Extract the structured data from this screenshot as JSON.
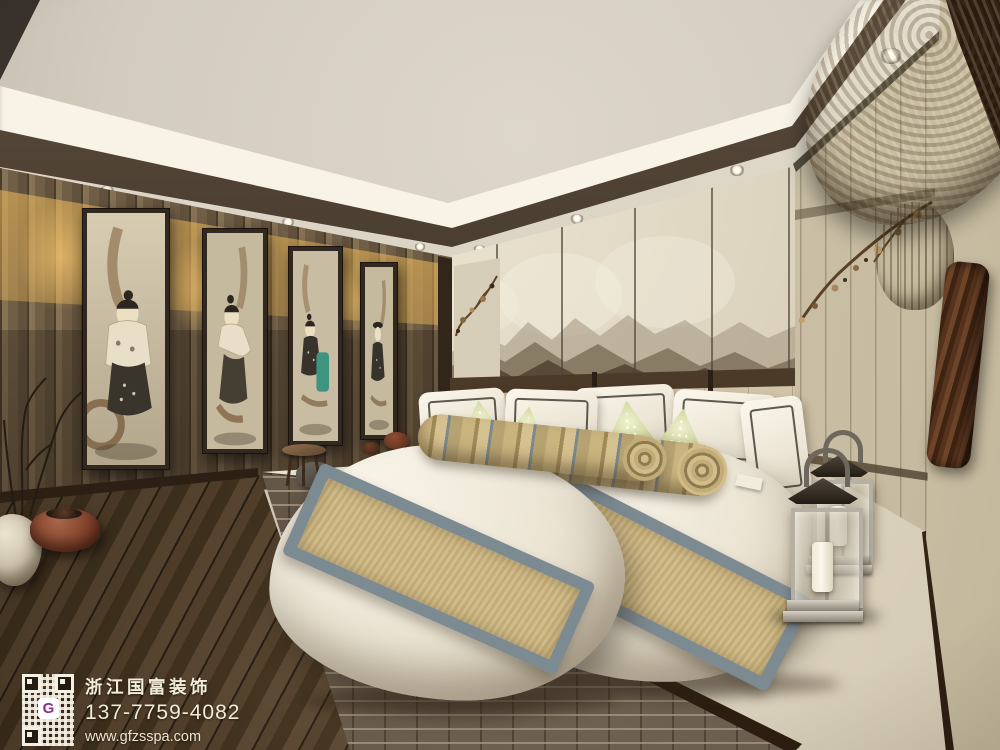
{
  "scene": {
    "room": "New Chinese style twin bedroom interior rendering",
    "objects": [
      "tray ceiling with cove lighting and recessed downlights",
      "wood slat wall with four framed figure paintings",
      "ink-wash mountain mural headboard wall",
      "upholstered headboard with dark wood rail",
      "two beds with tan runners and striped bolster pillows",
      "green patterned accent pillows and white framed shams",
      "brick-faced raised platform with cream top",
      "two stainless candle lanterns",
      "fabric panel right wall with metal blossom branch",
      "woven straw hat and leather strap in right foreground",
      "ceramic pot with dry branches and leather pouf",
      "dark wood plank floor"
    ]
  },
  "watermark": {
    "company": "浙江国富装饰",
    "phone": "137-7759-4082",
    "website": "www.gfzsspa.com",
    "qr_logo_letter": "G"
  },
  "palette": {
    "ceiling": "#d5cec0",
    "cove_light": "#f8f3e6",
    "ceiling_trim": "#3a2f24",
    "warm_glow": "#efbc5e",
    "wood_wall": "#77654c",
    "mural_base": "#ddd4bf",
    "mountain_dark": "#564a39",
    "bed_linen": "#ece5d5",
    "runner_tan": "#c3ac76",
    "runner_border": "#7c8a92",
    "pillow_green": "#c6cd90",
    "brick": "#6e6151",
    "platform_top": "#e5ddc9",
    "floor": "#4a3a2a",
    "right_wall": "#d4cab0",
    "lantern_metal": "#b6b0a4",
    "watermark_text": "#f3ecd8",
    "qr_logo_purple": "#8b2f8f"
  }
}
